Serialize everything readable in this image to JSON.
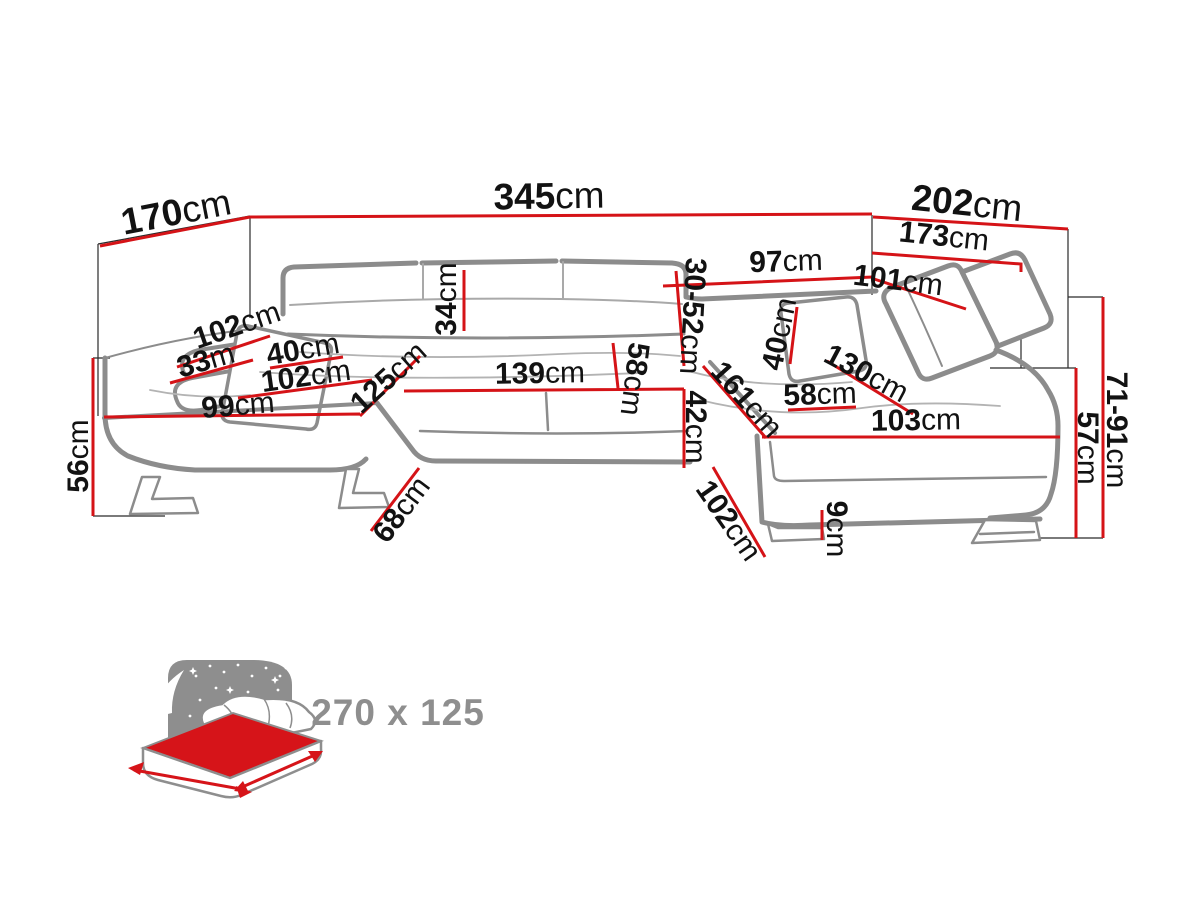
{
  "colors": {
    "dimension_line": "#d51317",
    "sofa_outline": "#8c8c8c",
    "helper_line": "#2a2a2a",
    "label_text": "#121212",
    "icon_gray": "#8e8e8e",
    "mattress_red": "#d61419"
  },
  "dimensions": [
    {
      "value": "170",
      "unit": "cm",
      "x": 176,
      "y": 212,
      "rot": -11,
      "size": 37
    },
    {
      "value": "345",
      "unit": "cm",
      "x": 549,
      "y": 196,
      "rot": -1,
      "size": 37
    },
    {
      "value": "202",
      "unit": "cm",
      "x": 967,
      "y": 203,
      "rot": 6,
      "size": 37
    },
    {
      "value": "173",
      "unit": "cm",
      "x": 944,
      "y": 237,
      "rot": 6,
      "size": 30
    },
    {
      "value": "97",
      "unit": "cm",
      "x": 786,
      "y": 262,
      "rot": -2,
      "size": 30
    },
    {
      "value": "101",
      "unit": "cm",
      "x": 898,
      "y": 281,
      "rot": 7,
      "size": 30
    },
    {
      "value": "34",
      "unit": "cm",
      "x": 447,
      "y": 299,
      "rot": -90,
      "size": 30
    },
    {
      "value": "30-52",
      "unit": "cm",
      "x": 692,
      "y": 316,
      "rot": 93,
      "size": 30
    },
    {
      "value": "102",
      "unit": "cm",
      "x": 237,
      "y": 326,
      "rot": -19,
      "size": 30
    },
    {
      "value": "33",
      "unit": "m",
      "x": 206,
      "y": 361,
      "rot": -16,
      "size": 30
    },
    {
      "value": "40",
      "unit": "cm",
      "x": 303,
      "y": 350,
      "rot": -10,
      "size": 30
    },
    {
      "value": "102",
      "unit": "cm",
      "x": 306,
      "y": 377,
      "rot": -8,
      "size": 30
    },
    {
      "value": "99",
      "unit": "cm",
      "x": 238,
      "y": 406,
      "rot": -5,
      "size": 30
    },
    {
      "value": "125",
      "unit": "cm",
      "x": 389,
      "y": 378,
      "rot": -42,
      "size": 30
    },
    {
      "value": "139",
      "unit": "cm",
      "x": 540,
      "y": 374,
      "rot": -1,
      "size": 30
    },
    {
      "value": "58",
      "unit": "cm",
      "x": 634,
      "y": 379,
      "rot": 97,
      "size": 30
    },
    {
      "value": "42",
      "unit": "cm",
      "x": 695,
      "y": 427,
      "rot": 90,
      "size": 30
    },
    {
      "value": "161",
      "unit": "cm",
      "x": 746,
      "y": 400,
      "rot": 48,
      "size": 30
    },
    {
      "value": "40",
      "unit": "cm",
      "x": 780,
      "y": 334,
      "rot": -78,
      "size": 30
    },
    {
      "value": "130",
      "unit": "cm",
      "x": 866,
      "y": 374,
      "rot": 28,
      "size": 30
    },
    {
      "value": "58",
      "unit": "cm",
      "x": 820,
      "y": 395,
      "rot": -2,
      "size": 30
    },
    {
      "value": "103",
      "unit": "cm",
      "x": 916,
      "y": 421,
      "rot": -1,
      "size": 30
    },
    {
      "value": "56",
      "unit": "cm",
      "x": 79,
      "y": 456,
      "rot": -90,
      "size": 30
    },
    {
      "value": "68",
      "unit": "cm",
      "x": 402,
      "y": 510,
      "rot": -53,
      "size": 30
    },
    {
      "value": "102",
      "unit": "cm",
      "x": 728,
      "y": 521,
      "rot": 55,
      "size": 30
    },
    {
      "value": "9",
      "unit": "cm",
      "x": 836,
      "y": 529,
      "rot": 90,
      "size": 30
    },
    {
      "value": "57",
      "unit": "cm",
      "x": 1087,
      "y": 448,
      "rot": 90,
      "size": 30
    },
    {
      "value": "71-91",
      "unit": "cm",
      "x": 1116,
      "y": 430,
      "rot": 90,
      "size": 30
    }
  ],
  "sleep_icon": {
    "icon": "starry-night-bed-icon",
    "size": "270 x 125"
  }
}
